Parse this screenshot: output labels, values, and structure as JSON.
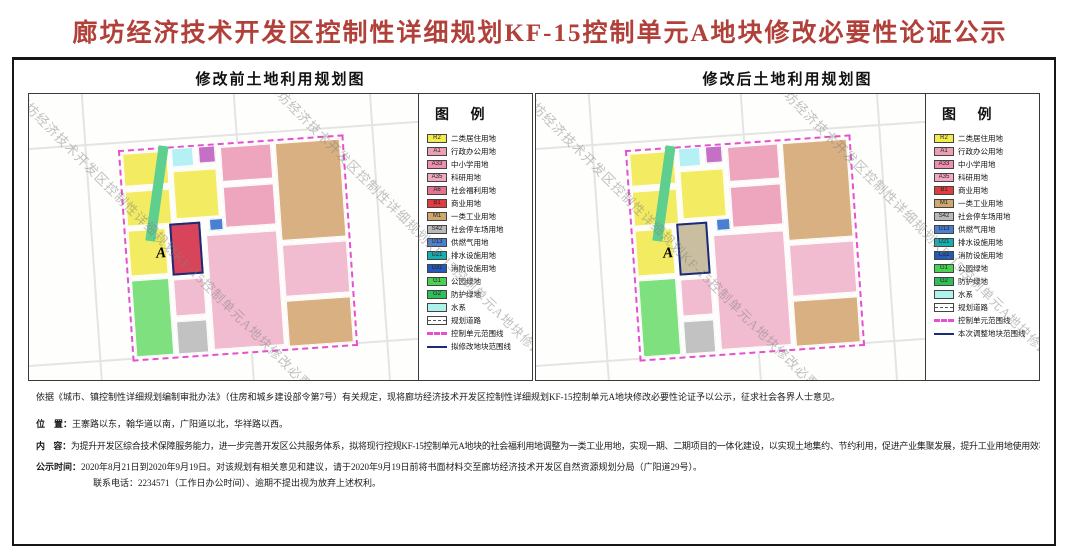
{
  "page_title": "廊坊经济技术开发区控制性详细规划KF-15控制单元A地块修改必要性论证公示",
  "watermark": "廊坊经济技术开发区控制性详细规划KF-15控制单元A地块修改必要性论证公示",
  "panels": [
    {
      "title": "修改前土地利用规划图",
      "legend_title": "图  例",
      "parcel_a": {
        "label": "A",
        "color": "#d8455a"
      },
      "legend_items": [
        {
          "code": "R2",
          "label": "二类居住用地",
          "color": "#f3ec4a",
          "kind": "fill"
        },
        {
          "code": "A1",
          "label": "行政办公用地",
          "color": "#eda0b4",
          "kind": "fill"
        },
        {
          "code": "A33",
          "label": "中小学用地",
          "color": "#ee8fb0",
          "kind": "fill"
        },
        {
          "code": "A35",
          "label": "科研用地",
          "color": "#f2a9c0",
          "kind": "fill"
        },
        {
          "code": "A6",
          "label": "社会福利用地",
          "color": "#e4738f",
          "kind": "fill"
        },
        {
          "code": "B1",
          "label": "商业用地",
          "color": "#e23b40",
          "kind": "fill"
        },
        {
          "code": "M1",
          "label": "一类工业用地",
          "color": "#d0a76c",
          "kind": "fill"
        },
        {
          "code": "S42",
          "label": "社会停车场用地",
          "color": "#b9b9b9",
          "kind": "fill"
        },
        {
          "code": "U13",
          "label": "供燃气用地",
          "color": "#4a7fd4",
          "kind": "fill"
        },
        {
          "code": "U21",
          "label": "排水设施用地",
          "color": "#12b0b0",
          "kind": "fill"
        },
        {
          "code": "U31",
          "label": "消防设施用地",
          "color": "#2559b8",
          "kind": "fill"
        },
        {
          "code": "G1",
          "label": "公园绿地",
          "color": "#49d154",
          "kind": "fill"
        },
        {
          "code": "G2",
          "label": "防护绿地",
          "color": "#2fbf58",
          "kind": "fill"
        },
        {
          "code": "",
          "label": "水系",
          "color": "#aef2ee",
          "kind": "fill"
        },
        {
          "code": "",
          "label": "规划道路",
          "color": "#ffffff",
          "kind": "road"
        },
        {
          "code": "",
          "label": "控制单元范围线",
          "color": "#e64fd0",
          "kind": "dash"
        },
        {
          "code": "",
          "label": "拟修改地块范围线",
          "color": "#1b2a7a",
          "kind": "line"
        }
      ]
    },
    {
      "title": "修改后土地利用规划图",
      "legend_title": "图  例",
      "parcel_a": {
        "label": "A",
        "color": "#c9bfa0"
      },
      "legend_items": [
        {
          "code": "R2",
          "label": "二类居住用地",
          "color": "#f3ec4a",
          "kind": "fill"
        },
        {
          "code": "A1",
          "label": "行政办公用地",
          "color": "#eda0b4",
          "kind": "fill"
        },
        {
          "code": "A33",
          "label": "中小学用地",
          "color": "#ee8fb0",
          "kind": "fill"
        },
        {
          "code": "A35",
          "label": "科研用地",
          "color": "#f2a9c0",
          "kind": "fill"
        },
        {
          "code": "B1",
          "label": "商业用地",
          "color": "#e23b40",
          "kind": "fill"
        },
        {
          "code": "M1",
          "label": "一类工业用地",
          "color": "#d0a76c",
          "kind": "fill"
        },
        {
          "code": "S42",
          "label": "社会停车场用地",
          "color": "#b9b9b9",
          "kind": "fill"
        },
        {
          "code": "U13",
          "label": "供燃气用地",
          "color": "#4a7fd4",
          "kind": "fill"
        },
        {
          "code": "U21",
          "label": "排水设施用地",
          "color": "#12b0b0",
          "kind": "fill"
        },
        {
          "code": "U31",
          "label": "消防设施用地",
          "color": "#2559b8",
          "kind": "fill"
        },
        {
          "code": "G1",
          "label": "公园绿地",
          "color": "#49d154",
          "kind": "fill"
        },
        {
          "code": "G2",
          "label": "防护绿地",
          "color": "#2fbf58",
          "kind": "fill"
        },
        {
          "code": "",
          "label": "水系",
          "color": "#aef2ee",
          "kind": "fill"
        },
        {
          "code": "",
          "label": "规划道路",
          "color": "#ffffff",
          "kind": "road"
        },
        {
          "code": "",
          "label": "控制单元范围线",
          "color": "#e64fd0",
          "kind": "dash"
        },
        {
          "code": "",
          "label": "本次调整地块范围线",
          "color": "#1b2a7a",
          "kind": "line"
        }
      ]
    }
  ],
  "map_parcels": [
    {
      "x": 1,
      "y": 1,
      "w": 20,
      "h": 16,
      "color": "#f3ec63"
    },
    {
      "x": 23,
      "y": 0,
      "w": 10,
      "h": 9,
      "color": "#b5f0f5"
    },
    {
      "x": 35,
      "y": 0,
      "w": 8,
      "h": 8,
      "color": "#c470c4"
    },
    {
      "x": 45,
      "y": 1,
      "w": 23,
      "h": 17,
      "color": "#eda6bd"
    },
    {
      "x": 70,
      "y": 1,
      "w": 29,
      "h": 47,
      "color": "#d8b082"
    },
    {
      "x": 1,
      "y": 19,
      "w": 20,
      "h": 17,
      "color": "#f3ec63"
    },
    {
      "x": 23,
      "y": 11,
      "w": 20,
      "h": 23,
      "color": "#f3ec63"
    },
    {
      "x": 45,
      "y": 20,
      "w": 23,
      "h": 20,
      "color": "#eda6bd"
    },
    {
      "x": 1,
      "y": 38,
      "w": 17,
      "h": 22,
      "color": "#f3ec63"
    },
    {
      "x": 38,
      "y": 35,
      "w": 6,
      "h": 6,
      "color": "#4a7fd4"
    },
    {
      "a": true,
      "x": 20,
      "y": 36,
      "w": 14,
      "h": 25
    },
    {
      "x": 36,
      "y": 43,
      "w": 32,
      "h": 55,
      "color": "#f2bcd0"
    },
    {
      "x": 1,
      "y": 62,
      "w": 17,
      "h": 37,
      "color": "#7fe07f"
    },
    {
      "x": 20,
      "y": 63,
      "w": 14,
      "h": 18,
      "color": "#f2bcd0"
    },
    {
      "x": 20,
      "y": 83,
      "w": 14,
      "h": 16,
      "color": "#c2c2c2"
    },
    {
      "x": 70,
      "y": 50,
      "w": 29,
      "h": 25,
      "color": "#f2bcd0"
    },
    {
      "x": 70,
      "y": 77,
      "w": 29,
      "h": 22,
      "color": "#d8b082"
    }
  ],
  "notes": {
    "intro": "依据《城市、镇控制性详细规划编制审批办法》（住房和城乡建设部令第7号）有关规定，现将廊坊经济技术开发区控制性详细规划KF-15控制单元A地块修改必要性论证予以公示，征求社会各界人士意见。",
    "location_label": "位　置：",
    "location": "王寨路以东，翰华道以南，广阳道以北，华祥路以西。",
    "content_label": "内　容：",
    "content": "为提升开发区综合技术保障服务能力，进一步完善开发区公共服务体系，拟将现行控规KF-15控制单元A地块的社会福利用地调整为一类工业用地，实现一期、二期项目的一体化建设，以实现土地集约、节约利用，促进产业集聚发展，提升工业用地使用效率和服务水平。",
    "time_label": "公示时间：",
    "time": "2020年8月21日到2020年9月19日。对该规划有相关意见和建议，请于2020年9月19日前将书面材料交至廊坊经济技术开发区自然资源规划分局（广阳道29号）。",
    "contact": "联系电话：2234571（工作日办公时间）、逾期不提出视为放弃上述权利。"
  }
}
